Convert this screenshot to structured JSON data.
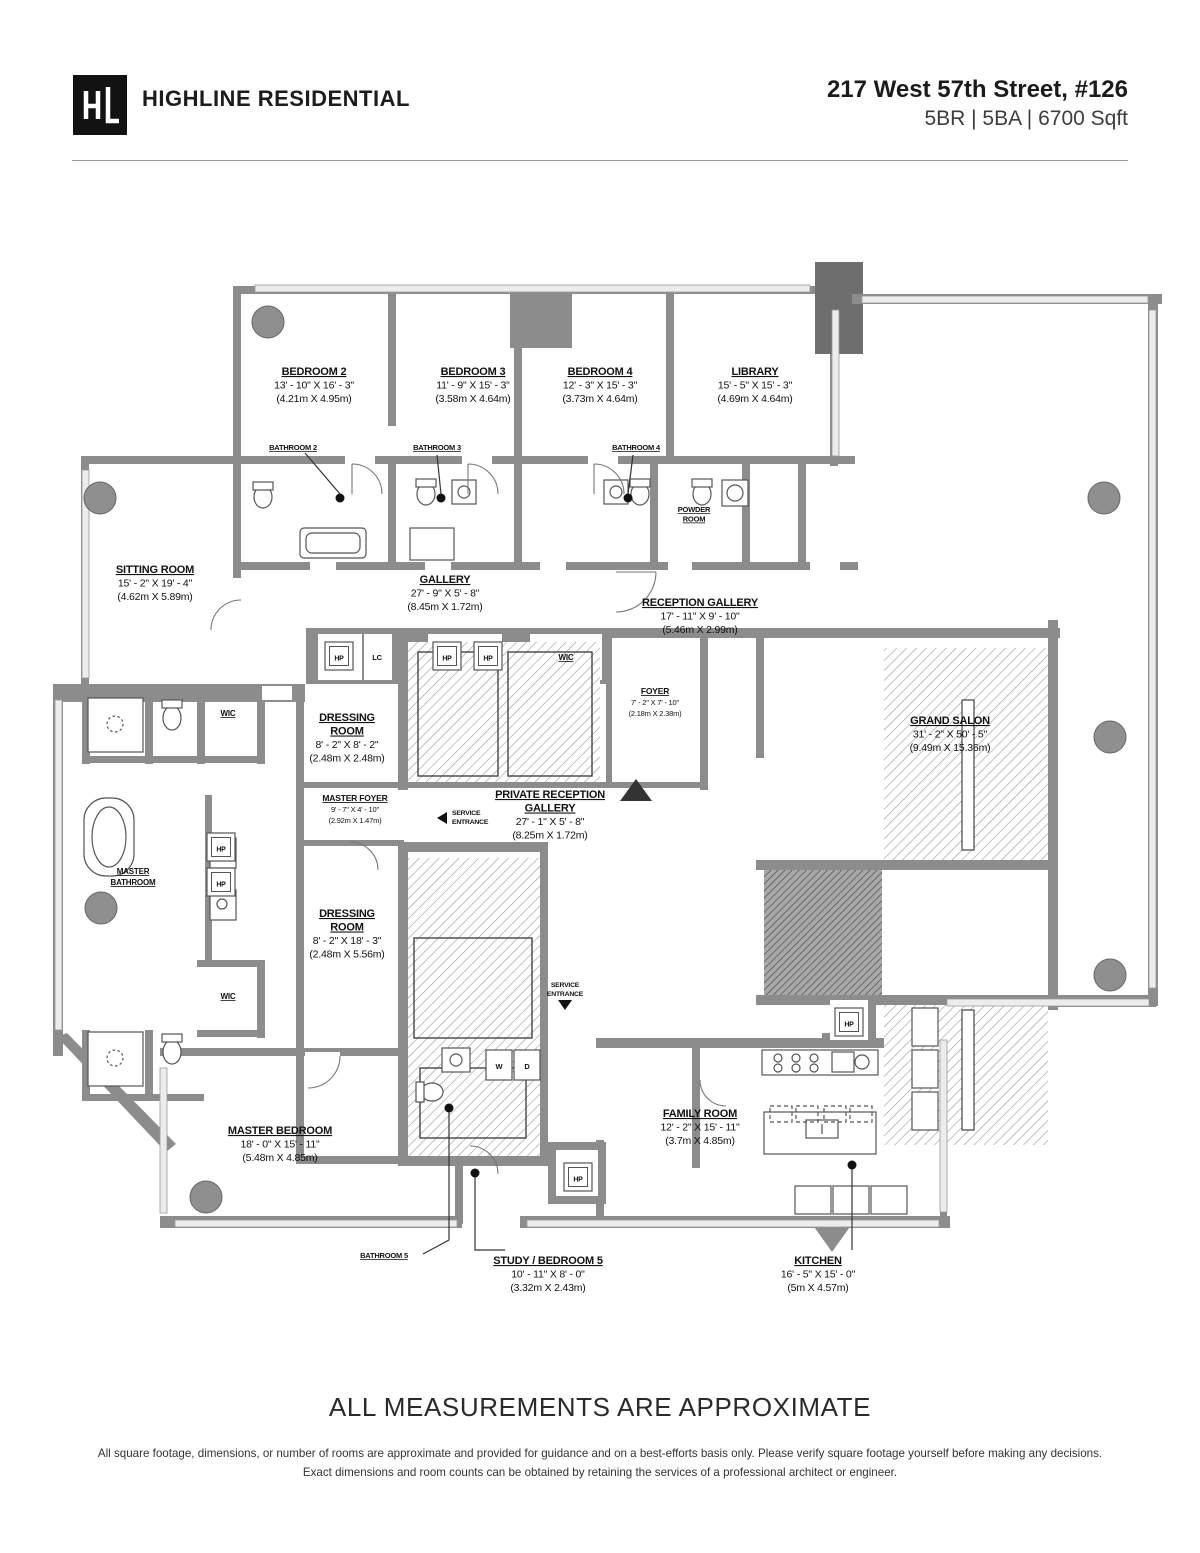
{
  "header": {
    "logo_monogram": "HL",
    "brand": "HIGHLINE RESIDENTIAL",
    "address": "217 West 57th Street, #126",
    "specs": "5BR | 5BA | 6700 Sqft"
  },
  "floorplan": {
    "rooms": [
      {
        "id": "bedroom2",
        "name": "BEDROOM 2",
        "dim_ft": "13' - 10\" X 16' - 3\"",
        "dim_m": "(4.21m X 4.95m)"
      },
      {
        "id": "bedroom3",
        "name": "BEDROOM 3",
        "dim_ft": "11' - 9\" X 15' - 3\"",
        "dim_m": "(3.58m X 4.64m)"
      },
      {
        "id": "bedroom4",
        "name": "BEDROOM 4",
        "dim_ft": "12' - 3\" X 15' - 3\"",
        "dim_m": "(3.73m X 4.64m)"
      },
      {
        "id": "library",
        "name": "LIBRARY",
        "dim_ft": "15' - 5\" X 15' - 3\"",
        "dim_m": "(4.69m X 4.64m)"
      },
      {
        "id": "sitting",
        "name": "SITTING ROOM",
        "dim_ft": "15' - 2\" X 19' - 4\"",
        "dim_m": "(4.62m X 5.89m)"
      },
      {
        "id": "gallery",
        "name": "GALLERY",
        "dim_ft": "27' - 9\" X 5' - 8\"",
        "dim_m": "(8.45m X 1.72m)"
      },
      {
        "id": "reception",
        "name": "RECEPTION GALLERY",
        "dim_ft": "17' - 11\" X 9' - 10\"",
        "dim_m": "(5.46m X 2.99m)"
      },
      {
        "id": "foyer",
        "name": "FOYER",
        "dim_ft": "7' - 2\" X 7' - 10\"",
        "dim_m": "(2.18m X 2.38m)"
      },
      {
        "id": "grandsalon",
        "name": "GRAND SALON",
        "dim_ft": "31' - 2\" X 50' - 5\"",
        "dim_m": "(9.49m X 15.36m)"
      },
      {
        "id": "dressing1",
        "name_lines": [
          "DRESSING",
          "ROOM"
        ],
        "dim_ft": "8' - 2\" X 8' - 2\"",
        "dim_m": "(2.48m X 2.48m)"
      },
      {
        "id": "masterfoyer",
        "name": "MASTER FOYER",
        "dim_ft": "9' - 7\" X 4' - 10\"",
        "dim_m": "(2.92m X 1.47m)"
      },
      {
        "id": "privatereception",
        "name_lines": [
          "PRIVATE RECEPTION",
          "GALLERY"
        ],
        "dim_ft": "27' - 1\" X 5' - 8\"",
        "dim_m": "(8.25m X 1.72m)"
      },
      {
        "id": "dressing2",
        "name_lines": [
          "DRESSING",
          "ROOM"
        ],
        "dim_ft": "8' - 2\" X 18' - 3\"",
        "dim_m": "(2.48m X 5.56m)"
      },
      {
        "id": "masterbedroom",
        "name": "MASTER BEDROOM",
        "dim_ft": "18' - 0\" X 15' - 11\"",
        "dim_m": "(5.48m X 4.85m)"
      },
      {
        "id": "familyroom",
        "name": "FAMILY ROOM",
        "dim_ft": "12' - 2\" X 15' - 11\"",
        "dim_m": "(3.7m X 4.85m)"
      },
      {
        "id": "study",
        "name": "STUDY / BEDROOM 5",
        "dim_ft": "10' - 11\" X 8' - 0\"",
        "dim_m": "(3.32m X 2.43m)"
      },
      {
        "id": "kitchen",
        "name": "KITCHEN",
        "dim_ft": "16' - 5\" X 15' - 0\"",
        "dim_m": "(5m X 4.57m)"
      }
    ],
    "labels": {
      "bathroom2": "BATHROOM 2",
      "bathroom3": "BATHROOM 3",
      "bathroom4": "BATHROOM 4",
      "bathroom5": "BATHROOM 5",
      "powder_room": [
        "POWDER",
        "ROOM"
      ],
      "master_bathroom": [
        "MASTER",
        "BATHROOM"
      ],
      "wic": "WIC",
      "lc": "LC",
      "hp": "HP",
      "washer": "W",
      "dryer": "D",
      "service_entrance": [
        "SERVICE",
        "ENTRANCE"
      ]
    },
    "colors": {
      "wall": "#8c8c8c",
      "dark_wall": "#6e6e6e",
      "window": "#ececec",
      "text": "#111111"
    }
  },
  "footer": {
    "title": "ALL MEASUREMENTS ARE APPROXIMATE",
    "disclaimer": "All square footage, dimensions, or number of rooms are approximate and provided for guidance and on a best-efforts basis only. Please verify square footage yourself before making any decisions. Exact dimensions and room counts can be obtained by retaining the services of a professional architect or engineer."
  }
}
